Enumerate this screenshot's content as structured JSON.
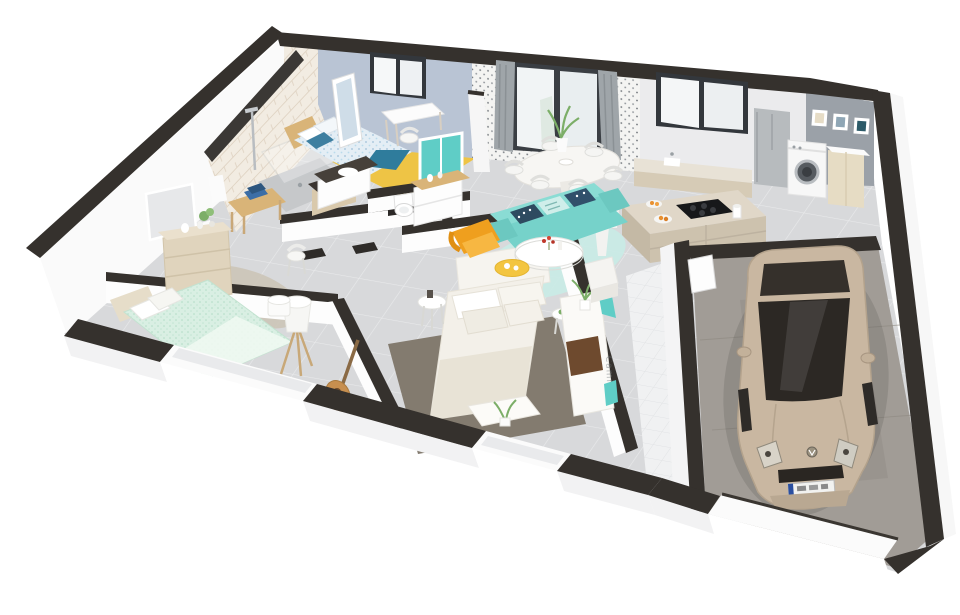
{
  "scene": {
    "type": "3d-dollhouse-floorplan-render",
    "description": "Cutaway 3D floor plan of a single-storey house with attached garage, viewed from above at an angle",
    "watermark": {
      "text": "Cami",
      "legibility": "low"
    },
    "rooms": [
      {
        "id": "bathroom",
        "label": "bathroom with walk-in shower"
      },
      {
        "id": "bedroom-1",
        "label": "bedroom with yellow rug and desk"
      },
      {
        "id": "dressing",
        "label": "dressing with teal sliding wardrobe"
      },
      {
        "id": "wc",
        "label": "separate WC"
      },
      {
        "id": "bedroom-2",
        "label": "bedroom with mint bed"
      },
      {
        "id": "master-bedroom",
        "label": "master bedroom with cream bed"
      },
      {
        "id": "living-room",
        "label": "living room with teal sofa"
      },
      {
        "id": "dining-area",
        "label": "dining area by glazed bay"
      },
      {
        "id": "kitchen",
        "label": "kitchen with island and stools"
      },
      {
        "id": "laundry",
        "label": "laundry corner with washing machine"
      },
      {
        "id": "entry-hall",
        "label": "white tiled entry hall"
      },
      {
        "id": "garage",
        "label": "garage with parked car"
      }
    ],
    "car": {
      "style": "champagne-beige hatchback, VW roundel badge, front license plate (illegible)"
    }
  },
  "palette": {
    "wallTop": "#35312d",
    "wallOuter": "#fafafa",
    "backWallBlue": "#b9c4d4",
    "backWallWhite": "#ebebed",
    "laundryWall": "#9ba1a8",
    "patternWallBase": "#f4f4f2",
    "brickWall": "#f2ece2",
    "floorTile": "#d8d9db",
    "garageFloor": "#a19c96",
    "entryTile": "#f0f1f2",
    "rugYellow": "#eec445",
    "rugLiving": "#c9ebe6",
    "rugMaster": "#837b6f",
    "rugShag": "#ccc5b8",
    "sofa": "#76d2ca",
    "sofaLight": "#8adcd4",
    "armchair": "#ef9f1e",
    "stool": "#f3a81f",
    "sideTableYellow": "#f3c540",
    "cushionNavy": "#2e4b60",
    "accentTeal": "#5fcdc6",
    "throwTeal": "#2f7c9c",
    "duvetBlue": "#e4eef5",
    "duvetMint": "#d9efe3",
    "bedCream": "#f3f0e9",
    "woodMid": "#d9b478",
    "dresserBeige": "#e0d4bd",
    "cabinetTaupe": "#cdc2ae",
    "counterTop": "#e0d7c8",
    "cooktop": "#17181a",
    "fridge": "#b7bbbe",
    "appliance": "#f7f7f7",
    "carBody": "#c9b7a1",
    "carGlass": "#2c2824",
    "throwBrown": "#6e4a2e",
    "guitar": "#c78f4f",
    "plant": "#7cae68",
    "curtain": "#9fa5a9",
    "windowFrame": "#33373c"
  }
}
